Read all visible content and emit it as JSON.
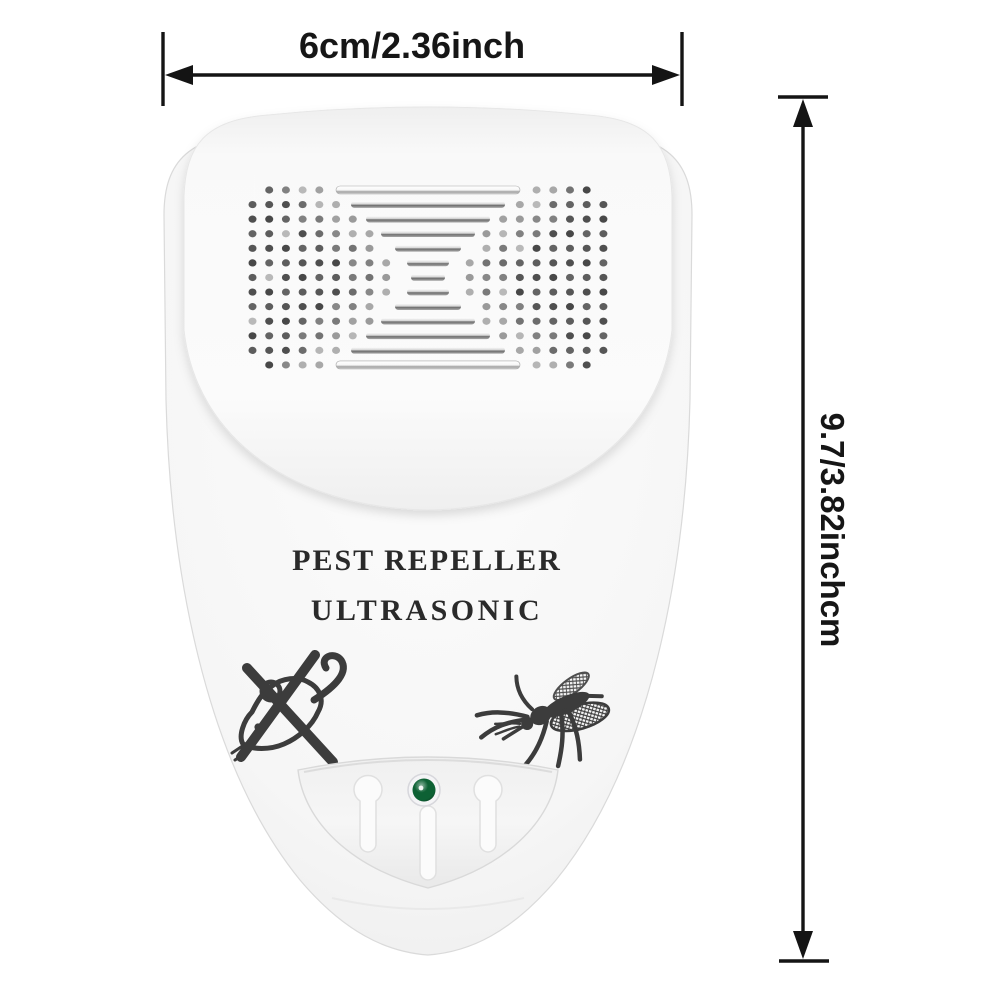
{
  "image_type": "product-dimension-photo",
  "background_color": "#ffffff",
  "annotation_color": "#141414",
  "dimensions": {
    "width_label": "6cm/2.36inch",
    "height_label": "9.7/3.82inchcm"
  },
  "device": {
    "name": "ultrasonic pest repeller (wall plug-in)",
    "body_color": "#f5f5f5",
    "label_line1": "PEST REPELLER",
    "label_line2": "ULTRASONIC",
    "label_color": "#2a2a2a",
    "led": {
      "label": "power-led",
      "color": "#0d6134",
      "state": "on"
    },
    "icons": [
      "speaker-grille",
      "mouse-crossed-icon",
      "mosquito-icon",
      "led-indicator"
    ],
    "grille": {
      "rows": 13,
      "cols": 22,
      "slot_halfwidths": [
        92,
        77,
        62,
        47,
        33,
        21,
        17,
        21,
        33,
        47,
        62,
        77,
        92
      ]
    }
  }
}
